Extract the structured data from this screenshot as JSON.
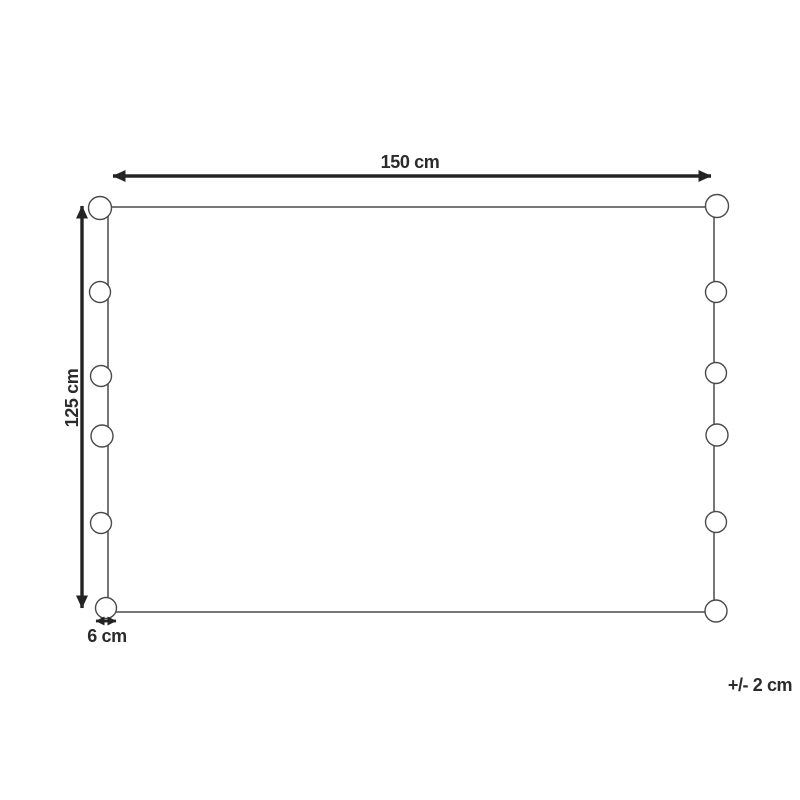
{
  "diagram": {
    "width_label": "150 cm",
    "height_label": "125 cm",
    "pompom_size_label": "6 cm",
    "tolerance_label": "+/- 2 cm"
  },
  "colors": {
    "background": "#ffffff",
    "outline": "#4a4a4a",
    "arrow": "#232323",
    "text": "#2b2b2b"
  }
}
